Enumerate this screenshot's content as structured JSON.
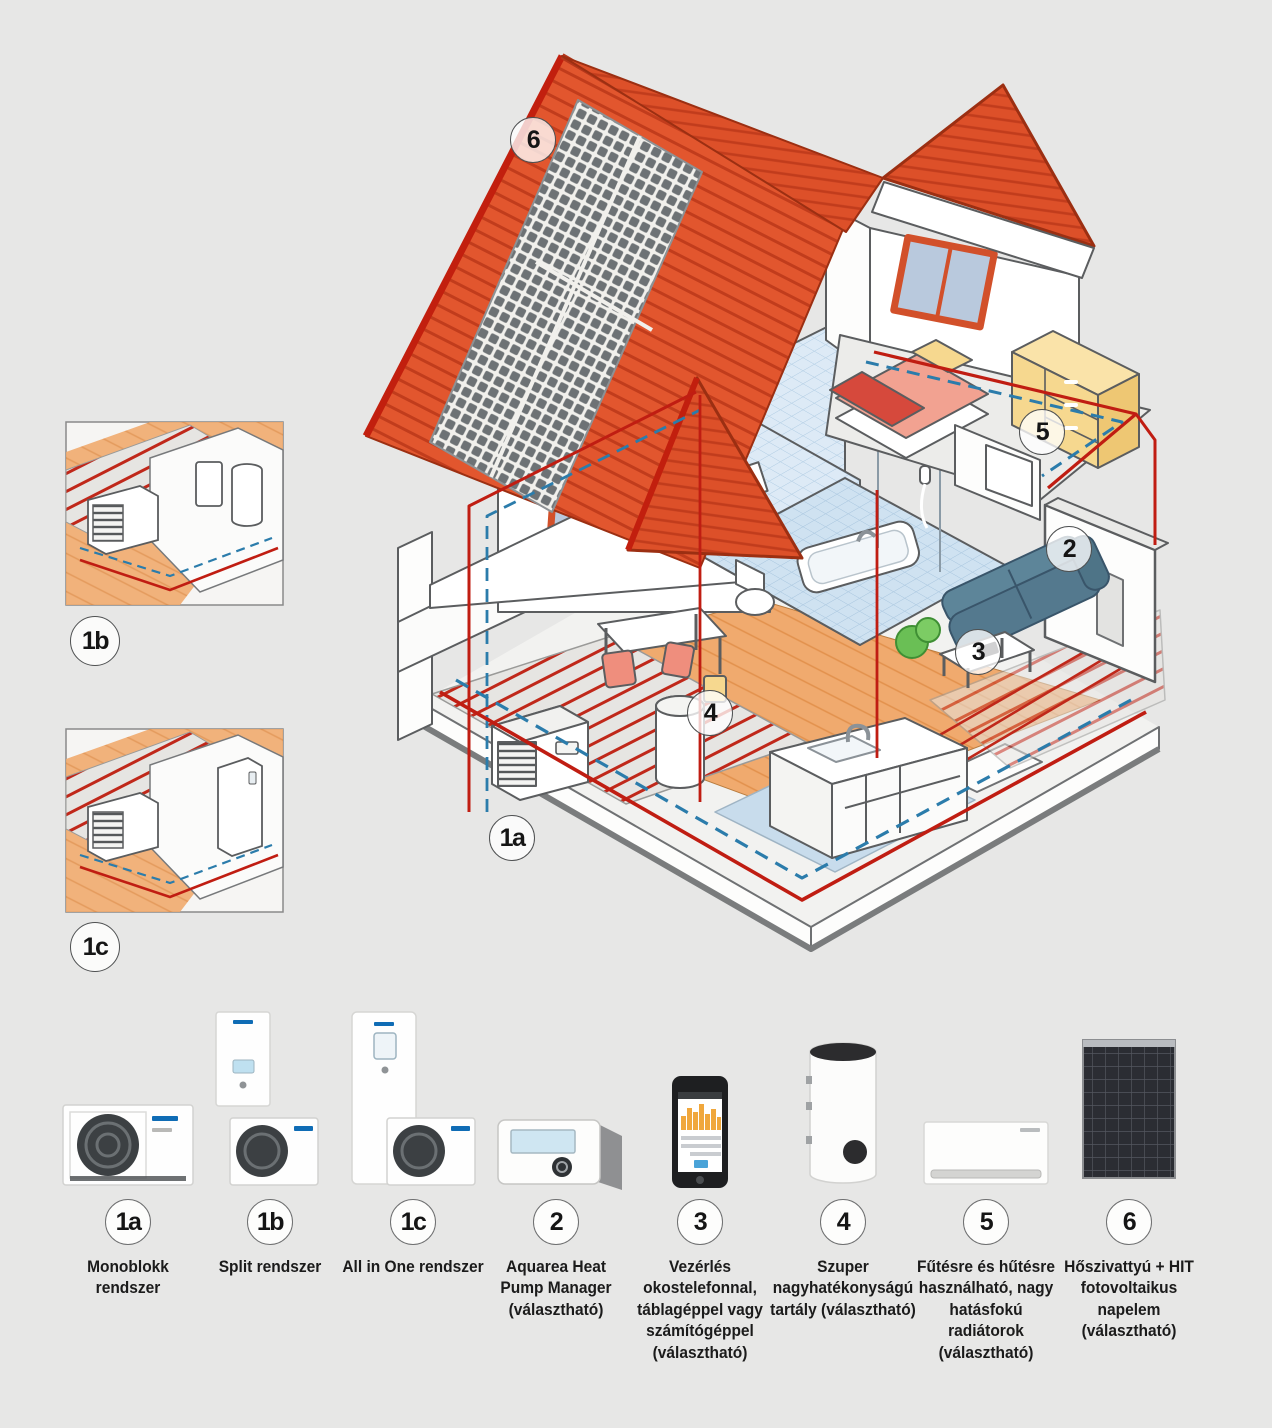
{
  "colors": {
    "background": "#e7e7e6",
    "roof": "#e2562e",
    "roof_stripe": "#c13c1c",
    "pipe_hot": "#c01d12",
    "pipe_cold": "#2b7cab",
    "wood_floor": "#f0aa6e",
    "bath_tile": "#d9e8f5",
    "sofa": "#5c8095",
    "window_frame": "#d2502a",
    "solar_cell": "#6d7275"
  },
  "diagram": {
    "callouts": [
      {
        "id": "6"
      },
      {
        "id": "5"
      },
      {
        "id": "2"
      },
      {
        "id": "3"
      },
      {
        "id": "4"
      },
      {
        "id": "1a"
      }
    ],
    "insets": [
      {
        "id": "1b"
      },
      {
        "id": "1c"
      }
    ]
  },
  "legend": {
    "items": [
      {
        "id": "1a",
        "label": "Monoblokk rendszer"
      },
      {
        "id": "1b",
        "label": "Split rendszer"
      },
      {
        "id": "1c",
        "label": "All in One rendszer"
      },
      {
        "id": "2",
        "label": "Aquarea Heat Pump Manager (választható)"
      },
      {
        "id": "3",
        "label": "Vezérlés okostelefonnal, táblagéppel vagy számítógéppel (választható)"
      },
      {
        "id": "4",
        "label": "Szuper nagyhatékonyságú tartály (választható)"
      },
      {
        "id": "5",
        "label": "Fűtésre és hűtésre használható, nagy hatásfokú radiátorok (választható)"
      },
      {
        "id": "6",
        "label": "Hőszivattyú + HIT fotovoltaikus napelem (választható)"
      }
    ]
  }
}
